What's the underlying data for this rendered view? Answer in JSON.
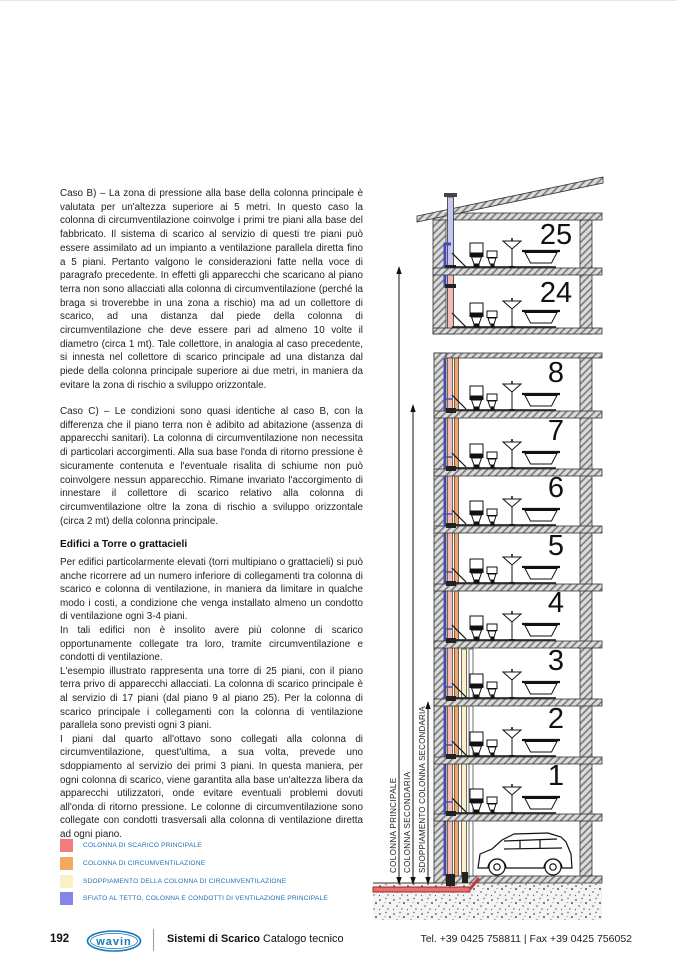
{
  "article": {
    "caso_b": "Caso B) – La zona di pressione alla base della colonna principale è valutata per un'altezza superiore ai 5 metri. In questo caso la colonna di circumventilazione coinvolge i primi tre piani alla base del fabbricato. Il sistema di scarico al servizio di questi tre piani può essere assimilato ad un impianto a ventilazione parallela diretta fino a 5 piani. Pertanto valgono le considerazioni fatte nella voce di paragrafo precedente. In effetti gli apparecchi che scaricano al piano terra non sono allacciati alla colonna di circumventilazione (perché la braga si troverebbe in una zona a rischio) ma ad un collettore di scarico, ad una distanza dal piede della colonna di circumventilazione che deve essere pari ad almeno 10 volte il diametro (circa 1 mt). Tale collettore, in analogia al caso precedente, si innesta nel collettore di scarico principale ad una distanza dal piede della colonna principale superiore ai due metri, in maniera da evitare la zona di rischio a sviluppo orizzontale.",
    "caso_c": "Caso C) – Le condizioni sono quasi identiche al caso B, con la differenza che il piano terra non è adibito ad abitazione (assenza di apparecchi sanitari). La colonna di circumventilazione non necessita di particolari accorgimenti. Alla sua base l'onda di ritorno pressione è sicuramente contenuta e l'eventuale risalita di schiume non può coinvolgere nessun apparecchio. Rimane invariato l'accorgimento di innestare il collettore di scarico relativo alla colonna di circumventilazione oltre la zona di rischio a sviluppo orizzontale (circa 2 mt) della colonna principale.",
    "tower_heading": "Edifici a Torre o grattacieli",
    "tower_p1": "Per edifici particolarmente elevati (torri multipiano o grattacieli) si può anche ricorrere ad un numero inferiore di collegamenti tra colonna di scarico e colonna di ventilazione, in maniera da limitare in qualche modo i costi, a condizione che venga installato almeno un condotto di ventilazione ogni 3-4 piani.",
    "tower_p2": "In tali edifici non è insolito avere più colonne di scarico opportunamente collegate tra loro, tramite circumventilazione e condotti di ventilazione.",
    "tower_p3": "L'esempio illustrato rappresenta una torre di 25 piani, con il piano terra privo di apparecchi allacciati. La colonna di scarico principale è al servizio di 17 piani (dal piano 9 al piano 25). Per la colonna di scarico principale i collegamenti con la colonna di ventilazione parallela sono previsti ogni 3 piani.",
    "tower_p4": "I piani dal quarto all'ottavo sono collegati alla colonna di circumventilazione, quest'ultima, a sua volta, prevede uno sdoppiamento al servizio dei primi 3 piani. In questa maniera, per ogni colonna di scarico, viene garantita alla base un'altezza libera da apparecchi utilizzatori, onde evitare eventuali problemi dovuti all'onda di ritorno pressione. Le colonne di circumventilazione sono collegate con condotti trasversali alla colonna di ventilazione diretta ad ogni piano."
  },
  "legend": {
    "items": [
      {
        "color": "#F07E7E",
        "label": "COLONNA DI SCARICO PRINCIPALE"
      },
      {
        "color": "#F5A95F",
        "label": "COLONNA DI CIRCUMVENTILAZIONE"
      },
      {
        "color": "#FAF0C8",
        "label": "SDOPPIAMENTO DELLA COLONNA DI CIRCUMVENTILAZIONE"
      },
      {
        "color": "#8585E8",
        "label": "SFIATO AL TETTO, COLONNA E CONDOTTI DI VENTILAZIONE PRINCIPALE"
      }
    ]
  },
  "diagram": {
    "floor_numbers": [
      "25",
      "24",
      "8",
      "7",
      "6",
      "5",
      "4",
      "3",
      "2",
      "1"
    ],
    "colonna_labels": [
      "COLONNA PRINCIPALE",
      "COLONNA SECONDARIA",
      "SDOPPIAMENTO COLONNA SECONDARIA"
    ],
    "colors": {
      "scarico_principale": "#F2BCB4",
      "circumventilazione": "#F2A766",
      "sdoppiamento": "#FAF0C8",
      "ventilazione": "#4848C0",
      "collettore": "#E87070"
    }
  },
  "footer": {
    "page_number": "192",
    "brand": "wavin",
    "title_bold": "Sistemi di Scarico",
    "title_regular": " Catalogo tecnico",
    "contact": "Tel. +39 0425 758811  |  Fax +39 0425 756052"
  }
}
